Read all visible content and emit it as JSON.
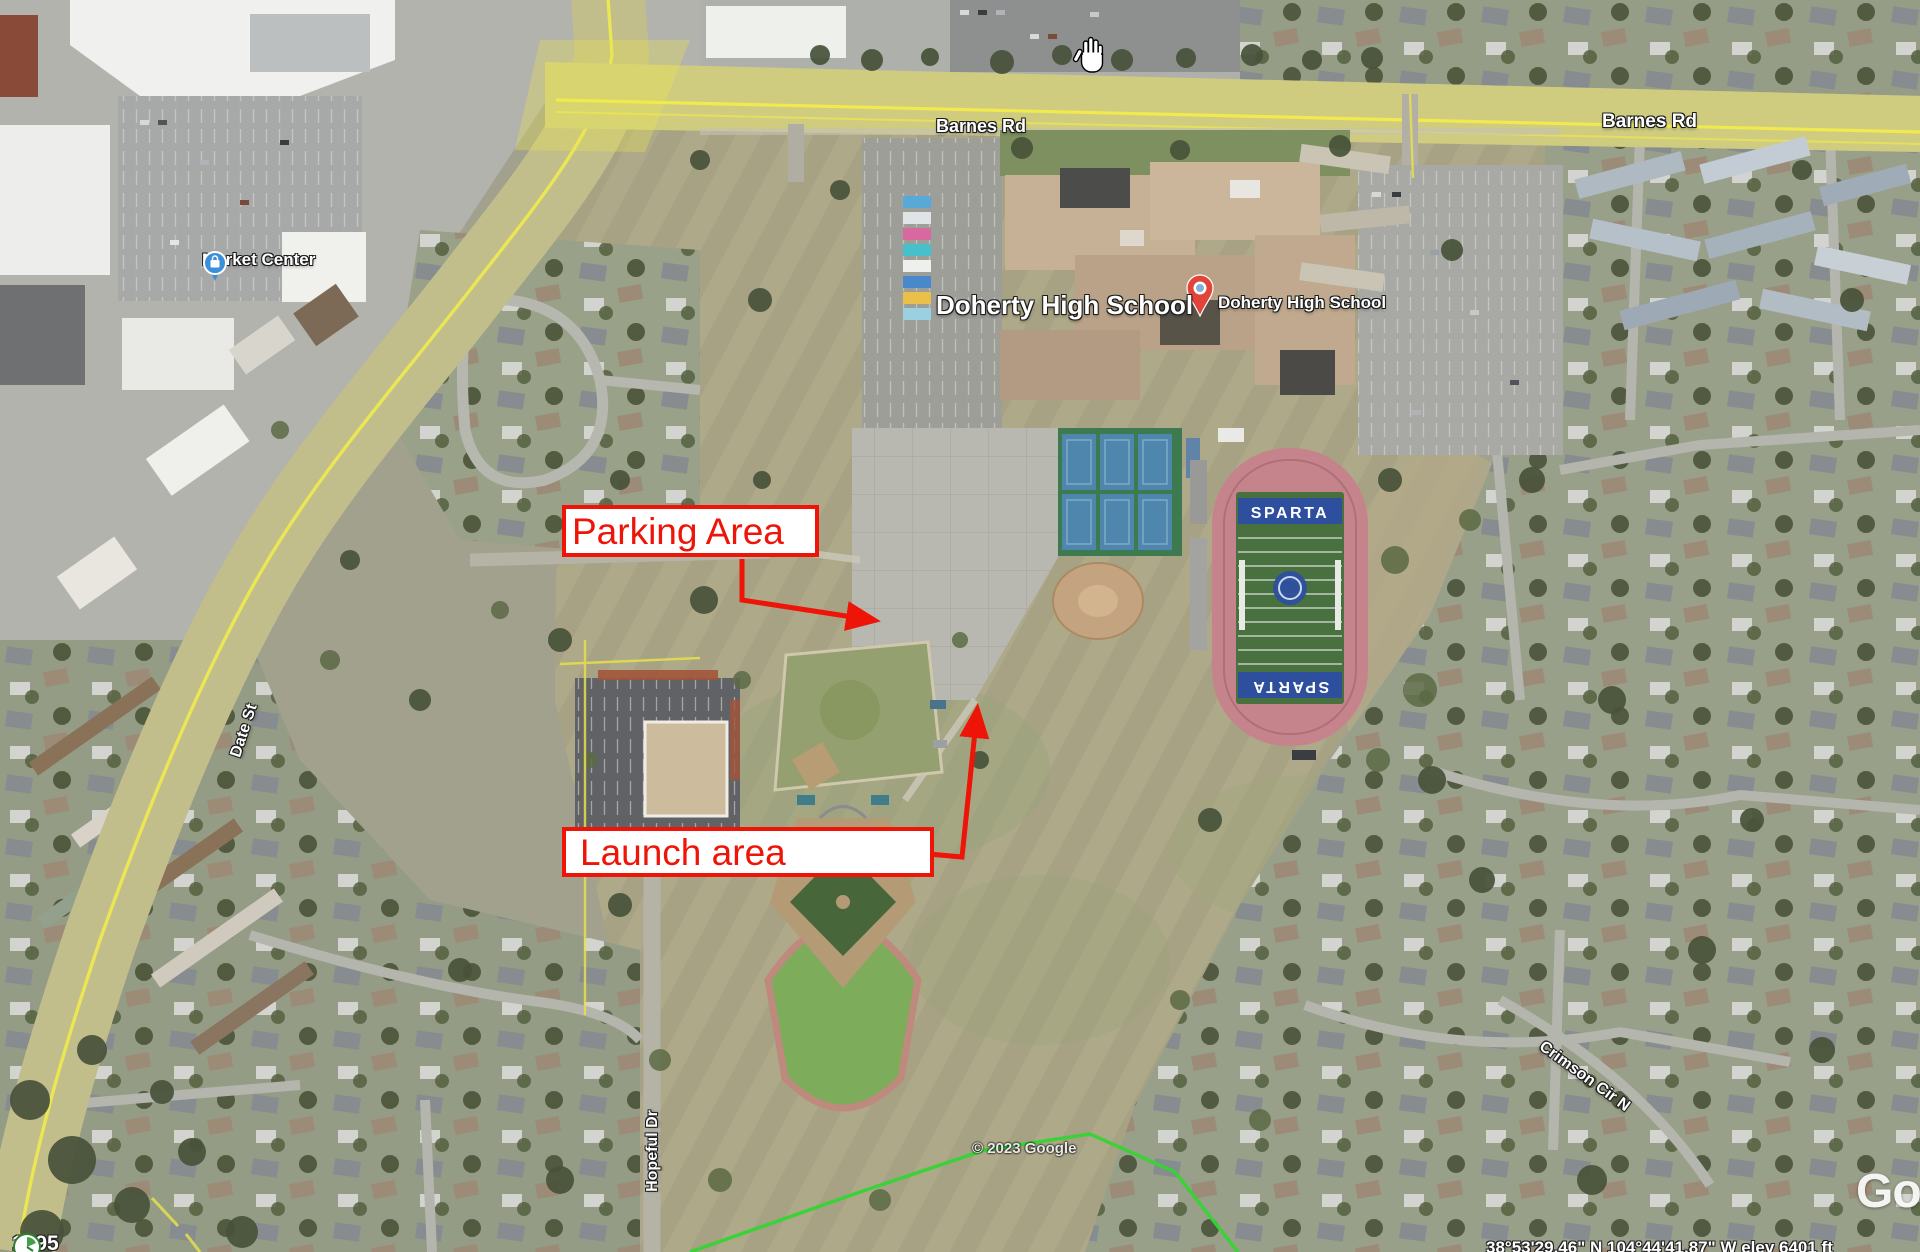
{
  "map_labels": {
    "barnes_rd_west": "Barnes Rd",
    "barnes_rd_east": "Barnes Rd",
    "market_center": "Market Center",
    "doherty_main": "Doherty High School",
    "doherty_pin": "Doherty High School",
    "date_st": "Date St",
    "hopeful_dr": "Hopeful Dr",
    "crimson_cir": "Crimson Cir N",
    "copyright": "© 2023 Google",
    "google_watermark_partial": "Go"
  },
  "annotations": {
    "parking_area": "Parking Area",
    "launch_area": "Launch area",
    "color": "#ee1408"
  },
  "stadium": {
    "endzone_north": "SPARTA",
    "endzone_south": "SPARTA"
  },
  "status_bar": {
    "history_year": "1995",
    "coordinates_clipped": "38°53'29.46\" N  104°44'41.87\" W  elev  6401 ft"
  },
  "icons": {
    "place_pin": "map-pin-icon",
    "market_center": "shopping-bag-icon",
    "cursor": "open-hand-cursor",
    "history": "clock-icon"
  }
}
